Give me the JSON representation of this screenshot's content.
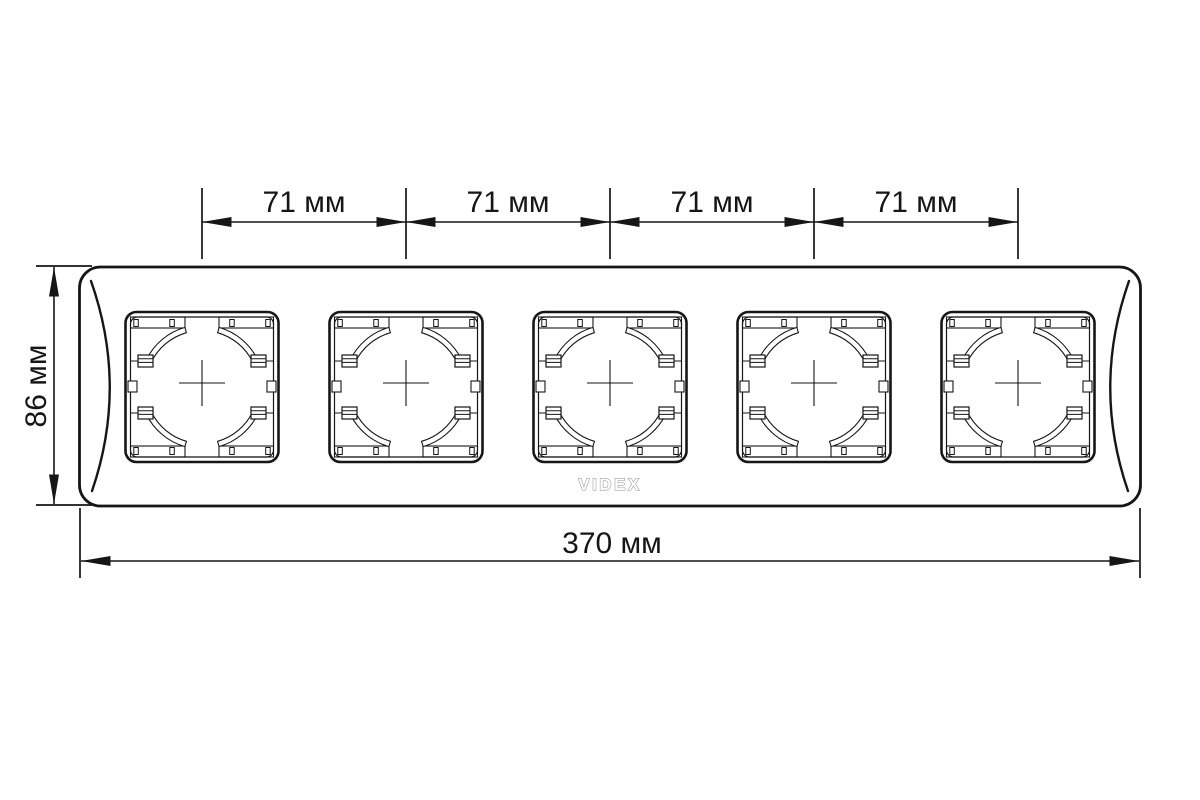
{
  "diagram": {
    "logo": "VIDEX",
    "socket_count": 5,
    "dim_top_labels": [
      "71 мм",
      "71 мм",
      "71 мм",
      "71 мм"
    ],
    "dim_height_label": "86 мм",
    "dim_width_label": "370 мм",
    "colors": {
      "line": "#161616",
      "logo_gray": "#8d8d8d",
      "background": "#ffffff"
    }
  }
}
